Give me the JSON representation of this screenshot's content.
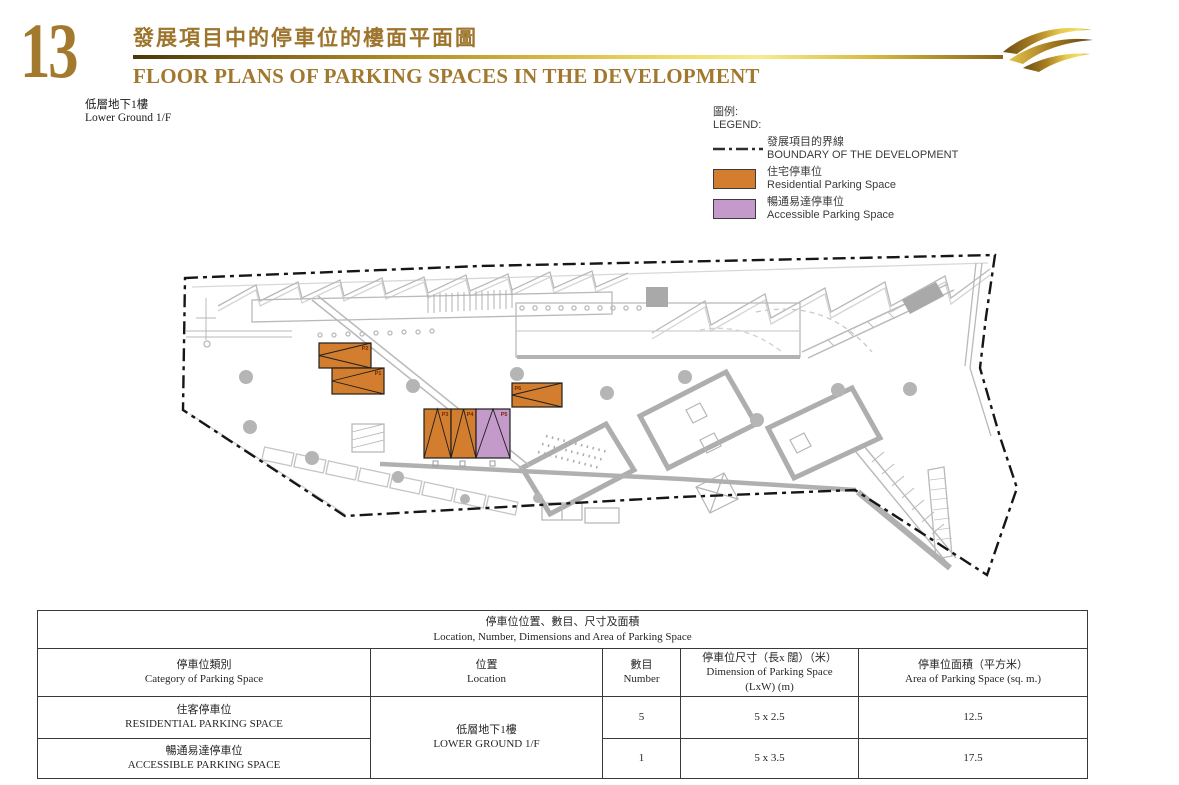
{
  "page": {
    "number": "13",
    "title_zh": "發展項目中的停車位的樓面平面圖",
    "title_en": "FLOOR PLANS OF PARKING SPACES IN THE DEVELOPMENT",
    "floor_zh": "低層地下1樓",
    "floor_en": "Lower Ground 1/F"
  },
  "legend": {
    "label_zh": "圖例:",
    "label_en": "LEGEND:",
    "items": [
      {
        "type": "boundary",
        "zh": "發展項目的界線",
        "en": "BOUNDARY OF THE DEVELOPMENT"
      },
      {
        "type": "residential",
        "zh": "住宅停車位",
        "en": "Residential Parking Space"
      },
      {
        "type": "accessible",
        "zh": "暢通易達停車位",
        "en": "Accessible Parking Space"
      }
    ]
  },
  "colors": {
    "residential": "#D27E2E",
    "accessible": "#C49ACA",
    "boundary": "#161616",
    "plan_gray": "#b9b9b9",
    "gold_title": "#A1782E",
    "stall_label": "#7a2500"
  },
  "plan": {
    "label_color": "#7a2500",
    "stalls": [
      {
        "id": "P2",
        "type": "residential",
        "x": 319,
        "y": 343,
        "w": 52,
        "h": 25,
        "orient": "h",
        "label_corner": "tr"
      },
      {
        "id": "P1",
        "type": "residential",
        "x": 332,
        "y": 368,
        "w": 52,
        "h": 26,
        "orient": "h",
        "label_corner": "tr"
      },
      {
        "id": "P3",
        "type": "residential",
        "x": 424,
        "y": 409,
        "w": 27,
        "h": 49,
        "orient": "v",
        "label_corner": "tr"
      },
      {
        "id": "P4",
        "type": "residential",
        "x": 451,
        "y": 409,
        "w": 25,
        "h": 49,
        "orient": "v",
        "label_corner": "tr"
      },
      {
        "id": "P5",
        "type": "accessible",
        "x": 476,
        "y": 409,
        "w": 34,
        "h": 49,
        "orient": "v",
        "label_corner": "tr"
      },
      {
        "id": "P6",
        "type": "residential",
        "x": 512,
        "y": 383,
        "w": 50,
        "h": 24,
        "orient": "h",
        "label_corner": "tl"
      }
    ]
  },
  "table": {
    "title_zh": "停車位位置、數目、尺寸及面積",
    "title_en": "Location, Number, Dimensions and Area of Parking Space",
    "headers": [
      {
        "zh": "停車位類別",
        "en": "Category of Parking Space"
      },
      {
        "zh": "位置",
        "en": "Location"
      },
      {
        "zh": "數目",
        "en": "Number"
      },
      {
        "zh": "停車位尺寸（長x 闊）（米）",
        "en": "Dimension of Parking Space (LxW) (m)"
      },
      {
        "zh": "停車位面積（平方米）",
        "en": "Area of Parking Space (sq. m.)"
      }
    ],
    "location": {
      "zh": "低層地下1樓",
      "en": "LOWER GROUND 1/F"
    },
    "rows": [
      {
        "category_zh": "住客停車位",
        "category_en": "RESIDENTIAL PARKING SPACE",
        "number": "5",
        "dimension": "5 x 2.5",
        "area": "12.5"
      },
      {
        "category_zh": "暢通易達停車位",
        "category_en": "ACCESSIBLE PARKING SPACE",
        "number": "1",
        "dimension": "5 x 3.5",
        "area": "17.5"
      }
    ]
  }
}
